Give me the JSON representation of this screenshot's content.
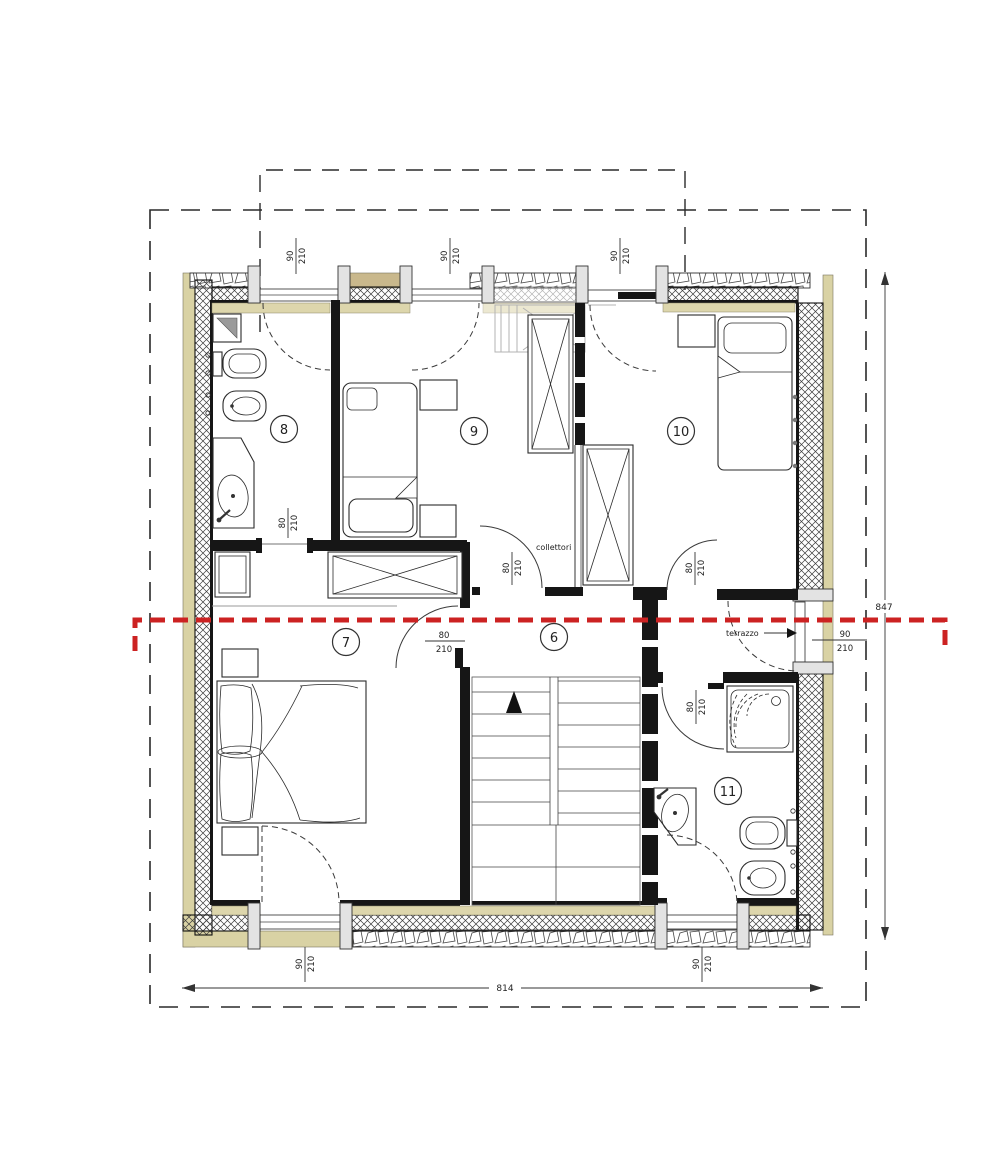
{
  "drawing": {
    "type": "architectural-floor-plan",
    "floor_rooms": [
      "6",
      "7",
      "8",
      "9",
      "10",
      "11"
    ],
    "section_line_color": "#cc2222",
    "wall_fill_color": "#161616",
    "plaster_band_color": "#d9d2a4",
    "dark_band_color": "#c9b88c"
  },
  "rooms": [
    {
      "number": "8",
      "cx": 284,
      "cy": 429
    },
    {
      "number": "9",
      "cx": 474,
      "cy": 431
    },
    {
      "number": "10",
      "cx": 681,
      "cy": 431
    },
    {
      "number": "7",
      "cx": 346,
      "cy": 642
    },
    {
      "number": "6",
      "cx": 554,
      "cy": 637
    },
    {
      "number": "11",
      "cx": 728,
      "cy": 791
    }
  ],
  "doors": [
    {
      "id": "top-door-1",
      "w": "90",
      "h": "210"
    },
    {
      "id": "top-door-2",
      "w": "90",
      "h": "210"
    },
    {
      "id": "top-door-3",
      "w": "90",
      "h": "210"
    },
    {
      "id": "bottom-door-1",
      "w": "90",
      "h": "210"
    },
    {
      "id": "bottom-door-2",
      "w": "90",
      "h": "210"
    },
    {
      "id": "bath8-door",
      "w": "80",
      "h": "210"
    },
    {
      "id": "room7-door",
      "w": "80",
      "h": "210"
    },
    {
      "id": "room9-door",
      "w": "80",
      "h": "210"
    },
    {
      "id": "room10-door",
      "w": "80",
      "h": "210"
    },
    {
      "id": "bath11-door",
      "w": "80",
      "h": "210"
    },
    {
      "id": "terrace-door",
      "w": "90",
      "h": "210"
    }
  ],
  "notes": {
    "collettori": "collettori",
    "terrazzo": "terrazzo"
  },
  "dims": {
    "overall_width": "814",
    "overall_height": "847"
  }
}
